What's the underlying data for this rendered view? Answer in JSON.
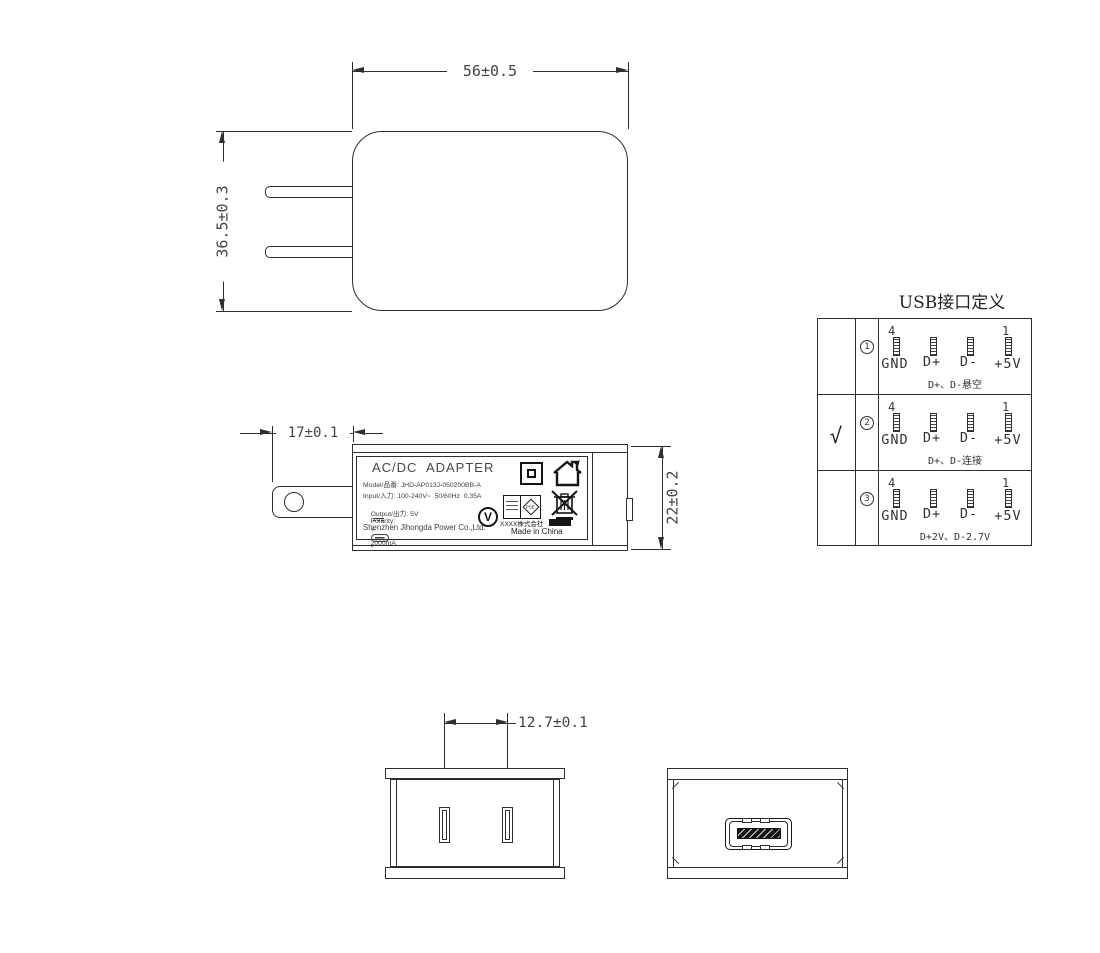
{
  "front_view": {
    "width_dim": "56±0.5",
    "height_dim": "36.5±0.3"
  },
  "side_view": {
    "blade_dim": "17±0.1",
    "depth_dim": "22±0.2"
  },
  "bottom_view": {
    "pitch_dim": "12.7±0.1"
  },
  "label": {
    "title": "AC/DC  ADAPTER",
    "model": "Model/品番: JHD-AP013J-050200BB-A",
    "input": "Input/入力: 100-240V~  50/60Hz  0.35A",
    "output_prefix": "Output/出力: 5V",
    "output_suffix": "2000mA",
    "polarity_label": "Polarity:",
    "polarity_plus": "+",
    "polarity_minus": "-",
    "company": "Shenzhen Jihongda Power Co.,Ltd.",
    "efficiency_mark": "V",
    "pse_mark": "PSE",
    "cert_company": "XXXX株式会社",
    "made_in": "Made in China"
  },
  "usb_table": {
    "title": "USB接口定义",
    "rows": [
      {
        "selected": "",
        "index": "1",
        "pin_first": "4",
        "pin_last": "1",
        "pins": [
          "GND",
          "D+",
          "D-",
          "+5V"
        ],
        "note": "D+、D-悬空"
      },
      {
        "selected": "√",
        "index": "2",
        "pin_first": "4",
        "pin_last": "1",
        "pins": [
          "GND",
          "D+",
          "D-",
          "+5V"
        ],
        "note": "D+、D-连接"
      },
      {
        "selected": "",
        "index": "3",
        "pin_first": "4",
        "pin_last": "1",
        "pins": [
          "GND",
          "D+",
          "D-",
          "+5V"
        ],
        "note": "D+2V、D-2.7V"
      }
    ]
  }
}
